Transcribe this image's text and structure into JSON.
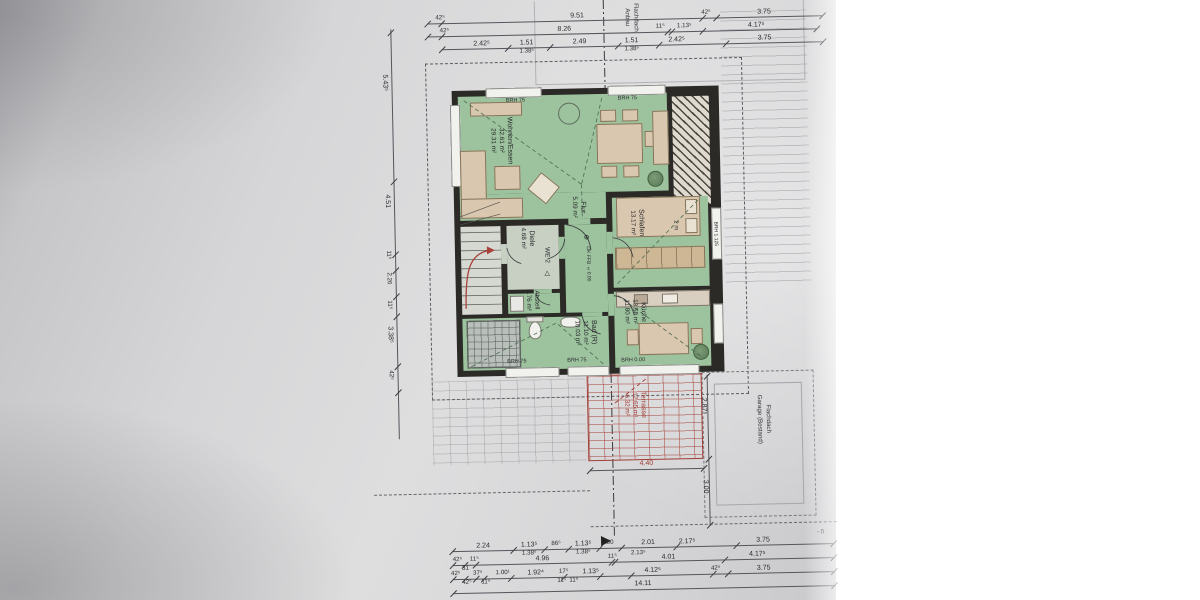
{
  "sheet": {
    "rooms": {
      "wohnen": {
        "name": "Wohnen/Essen",
        "area1": "32.61 m²",
        "area2": "29.31 m²"
      },
      "flur": {
        "name": "Flur",
        "area1": "5.09 m²"
      },
      "schlafen": {
        "name": "Schlafen",
        "area1": "13.17 m²"
      },
      "diele": {
        "name": "Diele",
        "area1": "4.68 m²"
      },
      "abstell": {
        "name": "Abstell",
        "area1": "2.76 m²"
      },
      "bad": {
        "name": "Bad (R)",
        "area1": "11.10 m²",
        "area2": "10.03 m²"
      },
      "kueche": {
        "name": "Küche",
        "area1": "13.58 m²",
        "area2": "11.80 m²"
      },
      "terrasse": {
        "name": "Terrasse",
        "area1": "12.65 m²",
        "area2": "6.32 m²"
      }
    },
    "marks": {
      "we": "WE 2",
      "level": "OK FFB ±0.00",
      "wardrobe": "2 m",
      "brh75": "BRH 75",
      "brh0": "BRH 0.00",
      "brh1125": "BRH 1.125",
      "minus0": "- 0"
    },
    "context": {
      "anbau1": "Flachdach",
      "anbau2": "Anbau",
      "garage1": "Flachdach",
      "garage2": "Garage (Bestand)"
    },
    "dims": {
      "top1": [
        "42⁵",
        "9.51",
        "42⁵",
        "3.75"
      ],
      "top2": [
        "42⁵",
        "8.26",
        "11⁵",
        "1.13⁵",
        "4.17⁵"
      ],
      "top3": [
        "2.42⁵",
        "1.51",
        "1.38⁵",
        "2.49",
        "1.51",
        "1.38⁵",
        "2.42⁵",
        "3.75"
      ],
      "left": [
        "5.43⁵",
        "4.51",
        "11⁵",
        "2.26",
        "11⁵",
        "3.38⁵",
        "42⁵"
      ],
      "terrace_right": [
        "2.87⁵",
        "3.00"
      ],
      "terrace_width": "4.40",
      "bottom1": [
        "2.24",
        "1.13⁵",
        "1.38⁵",
        "86⁵",
        "1.13⁵",
        "1.38⁵",
        "80",
        "2.01",
        "2.17⁵",
        "3.75"
      ],
      "bottom2": [
        "42⁵",
        "11⁵",
        "31",
        "4.96",
        "11⁵",
        "2.13⁵",
        "4.01",
        "4.17⁵"
      ],
      "bottom3": [
        "42⁵",
        "42⁵",
        "37⁵",
        "11⁵",
        "1.00¹",
        "1.92⁴",
        "17⁵",
        "11⁵",
        "11⁵",
        "1.13⁵",
        "4.12⁵",
        "42⁵",
        "3.75"
      ],
      "total": "14.11"
    }
  }
}
